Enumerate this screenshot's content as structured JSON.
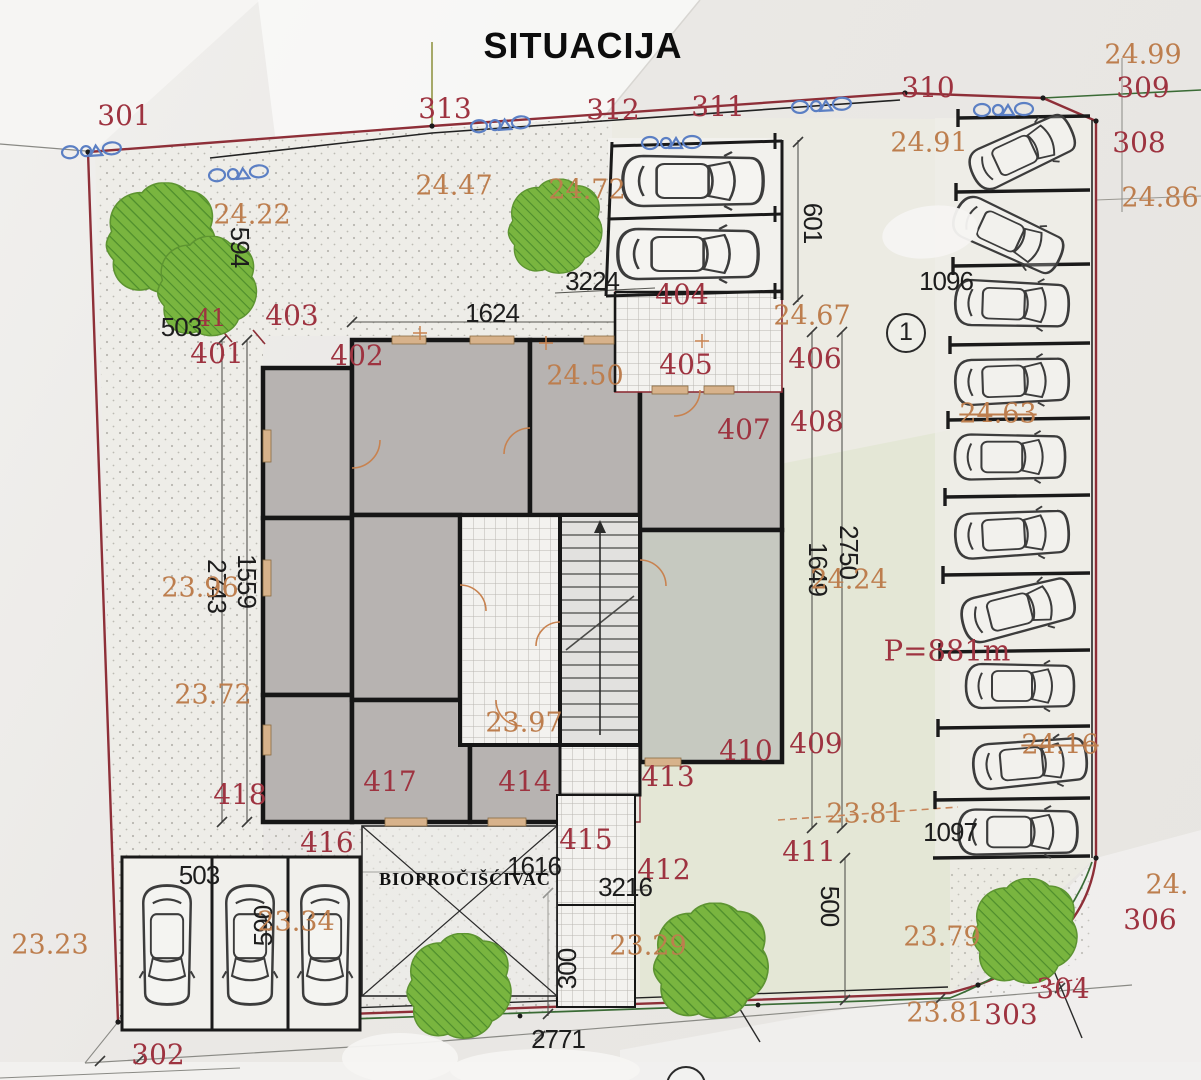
{
  "title": "SITUACIJA",
  "colors": {
    "boundary_red": "#8e2f38",
    "label_red": "#9e3340",
    "elevation_orange": "#bd7e4e",
    "dimension_black": "#1d1d1d",
    "tree_green": "#79b53f",
    "tree_hatch_green": "#4e8d2c",
    "utility_blue": "#5b7fc4",
    "building_gray": "#b7b3b1"
  },
  "annotations": [
    {
      "t": "301",
      "x": 124,
      "y": 116,
      "c": "red"
    },
    {
      "t": "313",
      "x": 445,
      "y": 109,
      "c": "red"
    },
    {
      "t": "312",
      "x": 613,
      "y": 110,
      "c": "red"
    },
    {
      "t": "311",
      "x": 718,
      "y": 107,
      "c": "red"
    },
    {
      "t": "310",
      "x": 928,
      "y": 88,
      "c": "red"
    },
    {
      "t": "309",
      "x": 1143,
      "y": 88,
      "c": "red"
    },
    {
      "t": "308",
      "x": 1139,
      "y": 143,
      "c": "red"
    },
    {
      "t": "306",
      "x": 1150,
      "y": 920,
      "c": "red"
    },
    {
      "t": "304",
      "x": 1063,
      "y": 989,
      "c": "red"
    },
    {
      "t": "303",
      "x": 1011,
      "y": 1015,
      "c": "red"
    },
    {
      "t": "302",
      "x": 158,
      "y": 1055,
      "c": "red"
    },
    {
      "t": "401",
      "x": 217,
      "y": 354,
      "c": "red"
    },
    {
      "t": "402",
      "x": 357,
      "y": 356,
      "c": "red"
    },
    {
      "t": "403",
      "x": 292,
      "y": 316,
      "c": "red"
    },
    {
      "t": "41",
      "x": 211,
      "y": 318,
      "c": "red",
      "s": 24
    },
    {
      "t": "404",
      "x": 682,
      "y": 295,
      "c": "red"
    },
    {
      "t": "405",
      "x": 686,
      "y": 365,
      "c": "red"
    },
    {
      "t": "406",
      "x": 815,
      "y": 359,
      "c": "red"
    },
    {
      "t": "407",
      "x": 744,
      "y": 430,
      "c": "red"
    },
    {
      "t": "408",
      "x": 817,
      "y": 422,
      "c": "red"
    },
    {
      "t": "409",
      "x": 816,
      "y": 744,
      "c": "red"
    },
    {
      "t": "410",
      "x": 746,
      "y": 751,
      "c": "red"
    },
    {
      "t": "411",
      "x": 809,
      "y": 852,
      "c": "red"
    },
    {
      "t": "412",
      "x": 664,
      "y": 870,
      "c": "red"
    },
    {
      "t": "413",
      "x": 668,
      "y": 777,
      "c": "red"
    },
    {
      "t": "414",
      "x": 525,
      "y": 782,
      "c": "red"
    },
    {
      "t": "415",
      "x": 586,
      "y": 840,
      "c": "red"
    },
    {
      "t": "416",
      "x": 327,
      "y": 843,
      "c": "red"
    },
    {
      "t": "417",
      "x": 390,
      "y": 782,
      "c": "red"
    },
    {
      "t": "418",
      "x": 240,
      "y": 795,
      "c": "red"
    },
    {
      "t": "P=881m",
      "x": 947,
      "y": 651,
      "c": "red",
      "s": 29,
      "n": "area-label"
    },
    {
      "t": "594",
      "x": 240,
      "y": 247,
      "c": "black",
      "rot": 90
    },
    {
      "t": "503",
      "x": 181,
      "y": 327,
      "c": "black"
    },
    {
      "t": "1624",
      "x": 492,
      "y": 313,
      "c": "black"
    },
    {
      "t": "3224",
      "x": 592,
      "y": 281,
      "c": "black"
    },
    {
      "t": "601",
      "x": 813,
      "y": 223,
      "c": "black",
      "rot": 90
    },
    {
      "t": "1096",
      "x": 946,
      "y": 281,
      "c": "black"
    },
    {
      "t": "2750",
      "x": 849,
      "y": 552,
      "c": "black",
      "rot": 90
    },
    {
      "t": "1649",
      "x": 818,
      "y": 569,
      "c": "black",
      "rot": 90
    },
    {
      "t": "1559",
      "x": 247,
      "y": 581,
      "c": "black",
      "rot": 90
    },
    {
      "t": "2743",
      "x": 217,
      "y": 586,
      "c": "black",
      "rot": 90
    },
    {
      "t": "1616",
      "x": 534,
      "y": 866,
      "c": "black"
    },
    {
      "t": "3216",
      "x": 625,
      "y": 887,
      "c": "black"
    },
    {
      "t": "1097",
      "x": 950,
      "y": 832,
      "c": "black"
    },
    {
      "t": "503",
      "x": 199,
      "y": 875,
      "c": "black"
    },
    {
      "t": "590",
      "x": 263,
      "y": 926,
      "c": "black",
      "rot": -90
    },
    {
      "t": "300",
      "x": 567,
      "y": 969,
      "c": "black",
      "rot": -90
    },
    {
      "t": "500",
      "x": 830,
      "y": 906,
      "c": "black",
      "rot": 90
    },
    {
      "t": "2771",
      "x": 558,
      "y": 1039,
      "c": "black"
    },
    {
      "t": "BIOPROČIŠĆIVAĆ",
      "x": 465,
      "y": 879,
      "c": "bio",
      "n": "bio-purifier-label"
    },
    {
      "t": "24.99",
      "x": 1143,
      "y": 55,
      "c": "orange"
    },
    {
      "t": "24.91",
      "x": 929,
      "y": 143,
      "c": "orange"
    },
    {
      "t": "24.86",
      "x": 1160,
      "y": 198,
      "c": "orange"
    },
    {
      "t": "24.72",
      "x": 587,
      "y": 190,
      "c": "orange"
    },
    {
      "t": "24.47",
      "x": 454,
      "y": 186,
      "c": "orange"
    },
    {
      "t": "24.22",
      "x": 252,
      "y": 215,
      "c": "orange"
    },
    {
      "t": "24.50",
      "x": 585,
      "y": 376,
      "c": "orange"
    },
    {
      "t": "24.67",
      "x": 812,
      "y": 316,
      "c": "orange"
    },
    {
      "t": "24.63",
      "x": 998,
      "y": 414,
      "c": "orange",
      "fx": "strike"
    },
    {
      "t": "24.24",
      "x": 849,
      "y": 580,
      "c": "orange"
    },
    {
      "t": "24.16",
      "x": 1060,
      "y": 745,
      "c": "orange",
      "fx": "strike"
    },
    {
      "t": "23.96",
      "x": 200,
      "y": 588,
      "c": "orange"
    },
    {
      "t": "23.72",
      "x": 213,
      "y": 695,
      "c": "orange"
    },
    {
      "t": "23.97",
      "x": 524,
      "y": 723,
      "c": "orange"
    },
    {
      "t": "23.81",
      "x": 865,
      "y": 814,
      "c": "orange"
    },
    {
      "t": "23.81",
      "x": 945,
      "y": 1013,
      "c": "orange"
    },
    {
      "t": "23.79",
      "x": 942,
      "y": 937,
      "c": "orange"
    },
    {
      "t": "23.29",
      "x": 648,
      "y": 946,
      "c": "orange"
    },
    {
      "t": "23.23",
      "x": 50,
      "y": 945,
      "c": "orange"
    },
    {
      "t": "23.34",
      "x": 296,
      "y": 922,
      "c": "orange"
    },
    {
      "t": "24.",
      "x": 1167,
      "y": 885,
      "c": "orange"
    },
    {
      "t": "1",
      "x": 906,
      "y": 333,
      "c": "circle",
      "n": "parking-area-marker-1"
    },
    {
      "t": "",
      "x": 686,
      "y": 1086,
      "c": "circle",
      "n": "parking-area-marker-2-partial"
    }
  ]
}
